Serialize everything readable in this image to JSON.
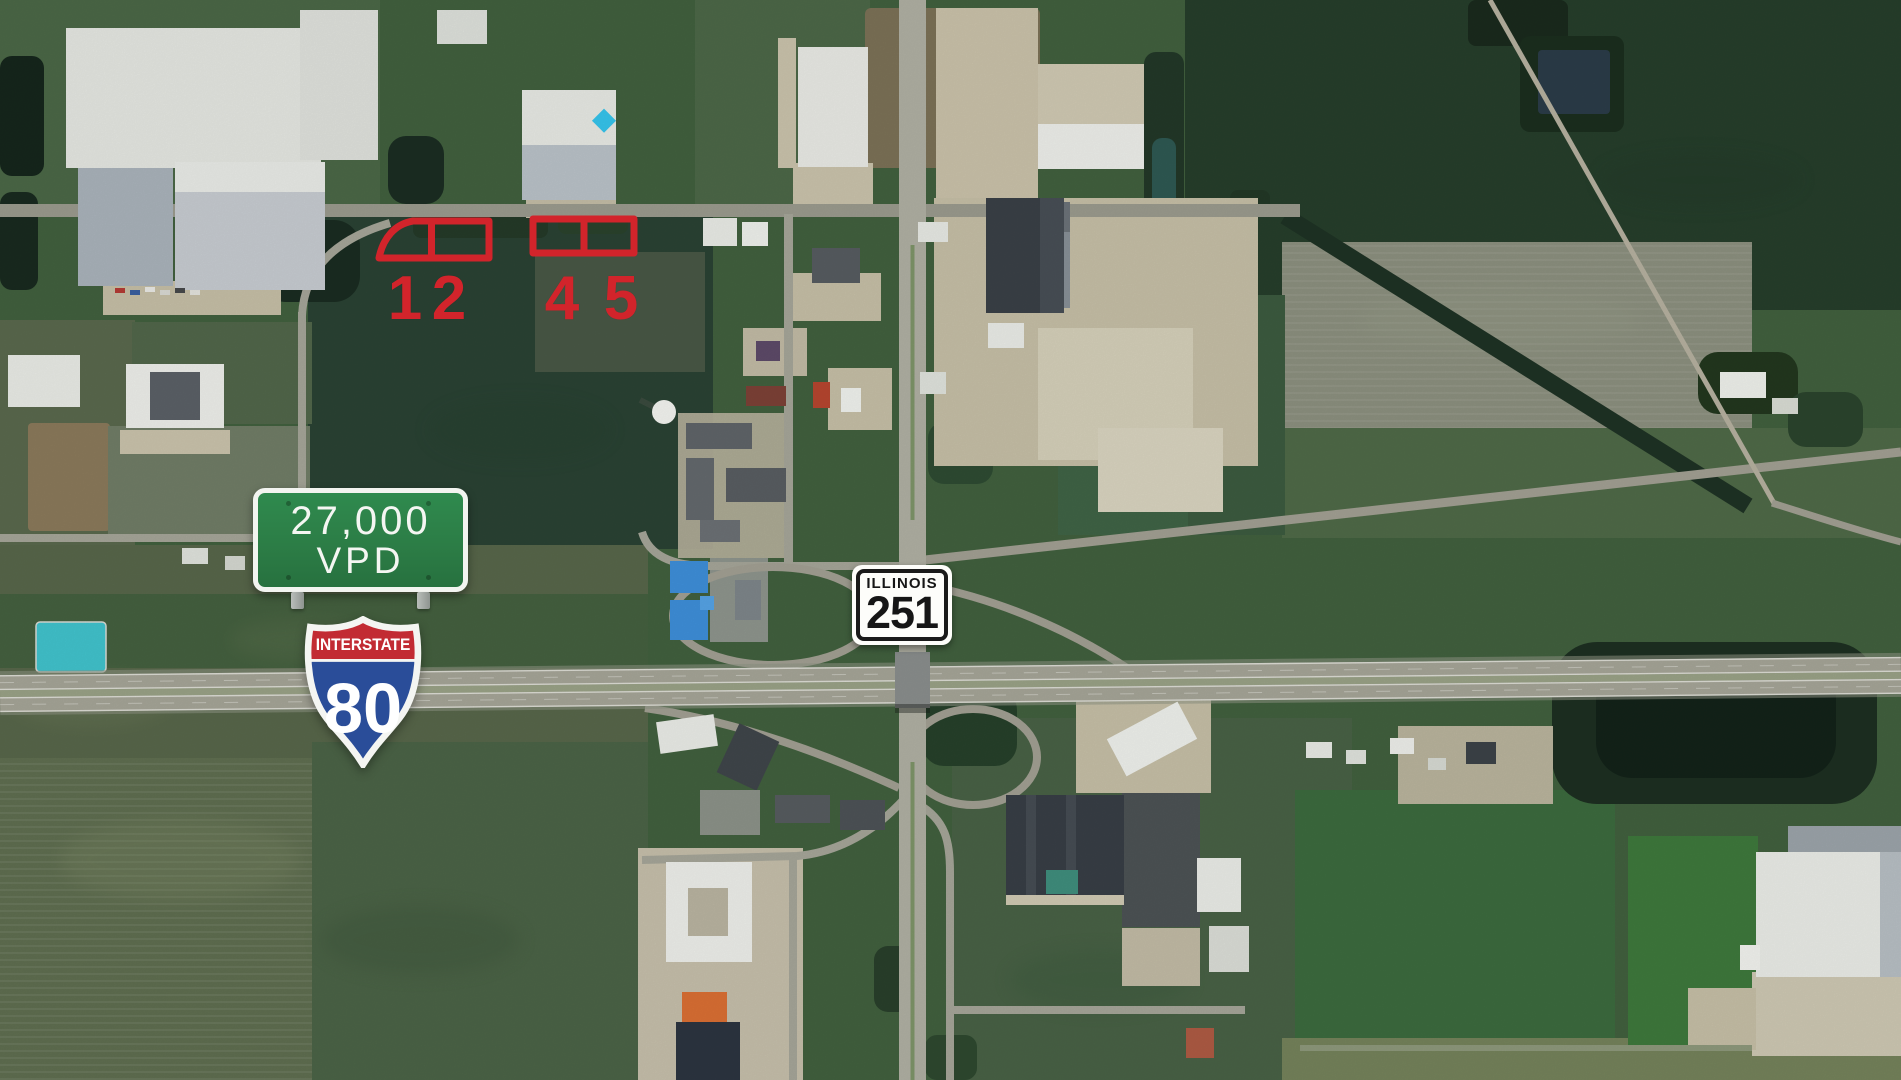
{
  "scene": {
    "kind": "aerial-satellite-imagery",
    "subject": "Interstate 80 and Illinois Route 251 interchange with outlined development parcels"
  },
  "annotations": {
    "parcels": {
      "outline_color": "#d2242b",
      "labels": [
        "1",
        "2",
        "4",
        "5"
      ]
    },
    "traffic_count_sign": {
      "line1": "27,000",
      "line2": "VPD",
      "background_color": "#2c7d46",
      "text_color": "#f4f6f2"
    },
    "interstate_shield": {
      "label": "INTERSTATE",
      "number": "80",
      "band_color": "#c22b33",
      "body_color": "#2a4d99"
    },
    "state_route_marker": {
      "state": "ILLINOIS",
      "number": "251",
      "text_color": "#161616"
    }
  }
}
